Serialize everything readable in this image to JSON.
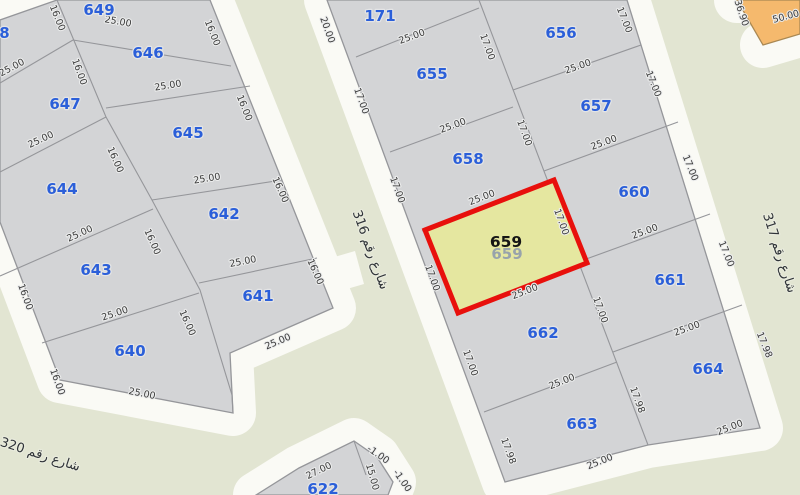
{
  "map": {
    "colors": {
      "background_green": "#e2e5d2",
      "road_white": "#fafaf5",
      "parcel_fill": "#d3d4d6",
      "parcel_stroke": "#95969a",
      "parcel_label_blue": "#2b5fd9",
      "dim_text": "#3a3a3a",
      "dim_halo": "#eceded",
      "highlight_fill": "#e5e7a0",
      "highlight_stroke": "#e8100c",
      "selected_label": "#151515",
      "ghost_label": "#98a3ab",
      "orange_fill": "#f5b96d",
      "orange_stroke": "#a98853",
      "street_text": "#2f3338"
    },
    "blocks": [
      {
        "id": "left-block",
        "fill": "parcel_fill",
        "stroke": "parcel_stroke",
        "apron": "open",
        "outline": [
          [
            0,
            20
          ],
          [
            57,
            0
          ],
          [
            210,
            0
          ],
          [
            333,
            308
          ],
          [
            230,
            353
          ],
          [
            233,
            413
          ],
          [
            60,
            380
          ],
          [
            0,
            222
          ]
        ],
        "lines": [
          [
            [
              57,
              0
            ],
            [
              106,
              117
            ],
            [
              152,
              200
            ],
            [
              200,
              290
            ],
            [
              232,
              395
            ],
            [
              233,
              413
            ]
          ],
          [
            [
              0,
              83
            ],
            [
              73,
              40
            ]
          ],
          [
            [
              73,
              40
            ],
            [
              231,
              66
            ]
          ],
          [
            [
              0,
              172
            ],
            [
              106,
              117
            ]
          ],
          [
            [
              106,
              108
            ],
            [
              250,
              86
            ]
          ],
          [
            [
              0,
              276
            ],
            [
              153,
              209
            ]
          ],
          [
            [
              152,
              200
            ],
            [
              282,
              180
            ]
          ],
          [
            [
              42,
              343
            ],
            [
              199,
              293
            ]
          ],
          [
            [
              199,
              283
            ],
            [
              317,
              258
            ]
          ]
        ]
      },
      {
        "id": "middle-block",
        "fill": "parcel_fill",
        "stroke": "parcel_stroke",
        "apron": "closed",
        "outline": [
          [
            327,
            0
          ],
          [
            627,
            0
          ],
          [
            760,
            428
          ],
          [
            648,
            445
          ],
          [
            505,
            482
          ]
        ],
        "lines": [
          [
            [
              479,
              0
            ],
            [
              648,
              445
            ]
          ],
          [
            [
              356,
              57
            ],
            [
              479,
              8
            ]
          ],
          [
            [
              390,
              152
            ],
            [
              513,
              107
            ]
          ],
          [
            [
              422,
              231
            ],
            [
              553,
              180
            ]
          ],
          [
            [
              458,
              313
            ],
            [
              587,
              263
            ]
          ],
          [
            [
              484,
              412
            ],
            [
              617,
              362
            ]
          ],
          [
            [
              513,
              90
            ],
            [
              641,
              45
            ]
          ],
          [
            [
              544,
              171
            ],
            [
              678,
              122
            ]
          ],
          [
            [
              578,
              262
            ],
            [
              710,
              214
            ]
          ],
          [
            [
              613,
              352
            ],
            [
              742,
              305
            ]
          ]
        ]
      },
      {
        "id": "bottom-block",
        "fill": "parcel_fill",
        "stroke": "parcel_stroke",
        "apron": "open",
        "outline": [
          [
            256,
            495
          ],
          [
            299,
            468
          ],
          [
            354,
            441
          ],
          [
            377,
            457
          ],
          [
            393,
            482
          ],
          [
            388,
            495
          ]
        ],
        "lines": [
          [
            [
              354,
              441
            ],
            [
              366,
              475
            ]
          ]
        ]
      },
      {
        "id": "orange-block",
        "fill": "orange_fill",
        "stroke": "orange_stroke",
        "apron": "open",
        "outline": [
          [
            737,
            0
          ],
          [
            800,
            0
          ],
          [
            800,
            34
          ],
          [
            763,
            45
          ]
        ],
        "lines": []
      }
    ],
    "white_patches": [
      [
        [
          331,
          258
        ],
        [
          355,
          251
        ],
        [
          364,
          284
        ],
        [
          340,
          291
        ]
      ]
    ],
    "parcels": [
      {
        "label": "648",
        "x": -6,
        "y": 33
      },
      {
        "label": "649",
        "x": 99,
        "y": 10
      },
      {
        "label": "646",
        "x": 148,
        "y": 53
      },
      {
        "label": "647",
        "x": 65,
        "y": 104
      },
      {
        "label": "645",
        "x": 188,
        "y": 133
      },
      {
        "label": "644",
        "x": 62,
        "y": 189
      },
      {
        "label": "642",
        "x": 224,
        "y": 214
      },
      {
        "label": "643",
        "x": 96,
        "y": 270
      },
      {
        "label": "641",
        "x": 258,
        "y": 296
      },
      {
        "label": "640",
        "x": 130,
        "y": 351
      },
      {
        "label": "171",
        "x": 380,
        "y": 16
      },
      {
        "label": "655",
        "x": 432,
        "y": 74
      },
      {
        "label": "658",
        "x": 468,
        "y": 159
      },
      {
        "label": "662",
        "x": 543,
        "y": 333
      },
      {
        "label": "663",
        "x": 582,
        "y": 424
      },
      {
        "label": "622",
        "x": 323,
        "y": 489
      },
      {
        "label": "656",
        "x": 561,
        "y": 33
      },
      {
        "label": "657",
        "x": 596,
        "y": 106
      },
      {
        "label": "660",
        "x": 634,
        "y": 192
      },
      {
        "label": "661",
        "x": 670,
        "y": 280
      },
      {
        "label": "664",
        "x": 708,
        "y": 369
      }
    ],
    "selected_parcel": {
      "label": "659",
      "x": 506,
      "y": 242,
      "ghost_x": 507,
      "ghost_y": 254,
      "polygon": [
        [
          425,
          230
        ],
        [
          554,
          180
        ],
        [
          587,
          263
        ],
        [
          458,
          313
        ]
      ]
    },
    "dims": [
      {
        "t": "25.00",
        "x": 118,
        "y": 22,
        "r": 10
      },
      {
        "t": "16.00",
        "x": 57,
        "y": 18,
        "r": 68
      },
      {
        "t": "16.00",
        "x": 212,
        "y": 33,
        "r": 68
      },
      {
        "t": "25.00",
        "x": 12,
        "y": 68,
        "r": -28
      },
      {
        "t": "16.00",
        "x": 79,
        "y": 72,
        "r": 70
      },
      {
        "t": "25.00",
        "x": 168,
        "y": 86,
        "r": -9
      },
      {
        "t": "16.00",
        "x": 244,
        "y": 108,
        "r": 68
      },
      {
        "t": "25.00",
        "x": 41,
        "y": 140,
        "r": -25
      },
      {
        "t": "16.00",
        "x": 115,
        "y": 160,
        "r": 66
      },
      {
        "t": "25.00",
        "x": 207,
        "y": 179,
        "r": -9
      },
      {
        "t": "16.00",
        "x": 280,
        "y": 190,
        "r": 66
      },
      {
        "t": "25.00",
        "x": 80,
        "y": 234,
        "r": -24
      },
      {
        "t": "16.00",
        "x": 152,
        "y": 242,
        "r": 66
      },
      {
        "t": "25.00",
        "x": 243,
        "y": 262,
        "r": -11
      },
      {
        "t": "16.00",
        "x": 315,
        "y": 272,
        "r": 66
      },
      {
        "t": "16.00",
        "x": 25,
        "y": 297,
        "r": 70
      },
      {
        "t": "25.00",
        "x": 115,
        "y": 314,
        "r": -18
      },
      {
        "t": "16.00",
        "x": 187,
        "y": 323,
        "r": 66
      },
      {
        "t": "25.00",
        "x": 278,
        "y": 342,
        "r": -23
      },
      {
        "t": "16.00",
        "x": 57,
        "y": 382,
        "r": 70
      },
      {
        "t": "25.00",
        "x": 142,
        "y": 394,
        "r": 11
      },
      {
        "t": "20.00",
        "x": 327,
        "y": 30,
        "r": 70
      },
      {
        "t": "25.00",
        "x": 412,
        "y": 37,
        "r": -20
      },
      {
        "t": "17.00",
        "x": 487,
        "y": 47,
        "r": 70
      },
      {
        "t": "17.00",
        "x": 624,
        "y": 20,
        "r": 68
      },
      {
        "t": "25.00",
        "x": 578,
        "y": 67,
        "r": -19
      },
      {
        "t": "17.00",
        "x": 653,
        "y": 84,
        "r": 68
      },
      {
        "t": "17.00",
        "x": 361,
        "y": 101,
        "r": 70
      },
      {
        "t": "25.00",
        "x": 453,
        "y": 126,
        "r": -20
      },
      {
        "t": "17.00",
        "x": 524,
        "y": 133,
        "r": 70
      },
      {
        "t": "25.00",
        "x": 604,
        "y": 143,
        "r": -20
      },
      {
        "t": "17.00",
        "x": 690,
        "y": 168,
        "r": 68
      },
      {
        "t": "17.00",
        "x": 397,
        "y": 190,
        "r": 70
      },
      {
        "t": "25.00",
        "x": 482,
        "y": 198,
        "r": -21
      },
      {
        "t": "17.00",
        "x": 561,
        "y": 222,
        "r": 70
      },
      {
        "t": "25.00",
        "x": 645,
        "y": 232,
        "r": -20
      },
      {
        "t": "17.00",
        "x": 726,
        "y": 254,
        "r": 68
      },
      {
        "t": "17.00",
        "x": 432,
        "y": 278,
        "r": 70
      },
      {
        "t": "25.00",
        "x": 525,
        "y": 292,
        "r": -21
      },
      {
        "t": "17.00",
        "x": 600,
        "y": 310,
        "r": 70
      },
      {
        "t": "25.00",
        "x": 687,
        "y": 329,
        "r": -20
      },
      {
        "t": "17.98",
        "x": 764,
        "y": 345,
        "r": 68
      },
      {
        "t": "17.00",
        "x": 470,
        "y": 363,
        "r": 70
      },
      {
        "t": "25.00",
        "x": 562,
        "y": 382,
        "r": -22
      },
      {
        "t": "17.98",
        "x": 637,
        "y": 400,
        "r": 70
      },
      {
        "t": "25.00",
        "x": 730,
        "y": 428,
        "r": -21
      },
      {
        "t": "17.98",
        "x": 508,
        "y": 451,
        "r": 70
      },
      {
        "t": "25.00",
        "x": 600,
        "y": 462,
        "r": -22
      },
      {
        "t": "27.00",
        "x": 319,
        "y": 471,
        "r": -26
      },
      {
        "t": "-1.00",
        "x": 378,
        "y": 455,
        "r": 35
      },
      {
        "t": "15.00",
        "x": 372,
        "y": 477,
        "r": 74
      },
      {
        "t": "-1.00",
        "x": 402,
        "y": 481,
        "r": 55
      },
      {
        "t": "36.90",
        "x": 741,
        "y": 13,
        "r": 72
      },
      {
        "t": "50.00",
        "x": 786,
        "y": 17,
        "r": -15
      }
    ],
    "streets": [
      {
        "label": "شارع رقم 316",
        "x": 370,
        "y": 250,
        "r": 70
      },
      {
        "label": "شارع رقم 317",
        "x": 779,
        "y": 253,
        "r": 72
      },
      {
        "label": "شارع رقم 320",
        "x": 40,
        "y": 455,
        "r": 18
      }
    ]
  }
}
